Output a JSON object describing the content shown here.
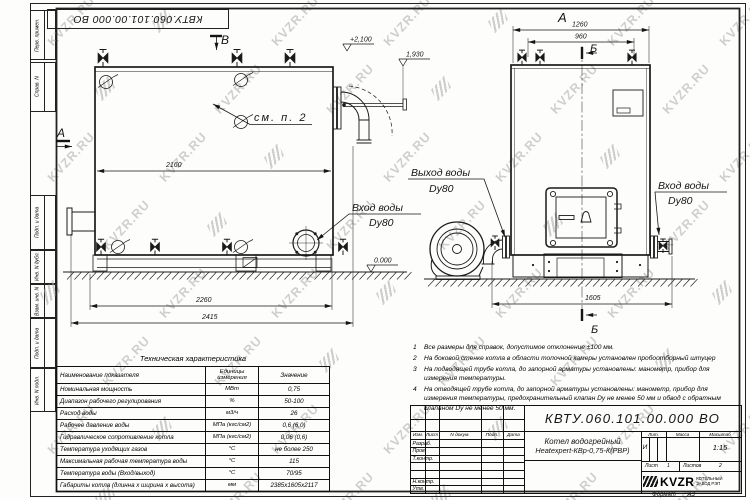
{
  "watermark": {
    "text": "KVZR.RU"
  },
  "margin_fields": [
    "Перв. примен.",
    "Справ. N",
    "Подп. и дата",
    "Инв. N дубл.",
    "Взам. инв. N",
    "Подп. и дата",
    "Инв. N подл."
  ],
  "drawing": {
    "left_view": {
      "view_arrow": "В",
      "section_label": "А",
      "note_ref": "см. п. 2",
      "elev_top": "+2,100",
      "elev_flue": "1,930",
      "elev_zero": "0.000",
      "dim_width_inner": "2160",
      "dim_width_base": "2260",
      "dim_width_total": "2415",
      "inlet_line1": "Вход воды",
      "inlet_line2": "Dy80"
    },
    "right_view": {
      "view_label": "А",
      "section_top": "Б",
      "section_bottom": "Б",
      "dim_top_outer": "1260",
      "dim_top_inner": "960",
      "dim_base": "1605",
      "outlet_line1": "Выход воды",
      "outlet_line2": "Dy80",
      "inlet_line1": "Вход воды",
      "inlet_line2": "Dy80"
    }
  },
  "spec_table": {
    "title": "Техническая характеристика",
    "headers": [
      "Наименование показателя",
      "Единицы измерения",
      "Значение"
    ],
    "rows": [
      [
        "Номинальная мощность",
        "МВт",
        "0,75"
      ],
      [
        "Диапазон рабочего регулирования",
        "%",
        "50-100"
      ],
      [
        "Расход воды",
        "м3/ч",
        "26"
      ],
      [
        "Рабочее давление воды",
        "МПа (кгс/см2)",
        "0,6 (6,0)"
      ],
      [
        "Гидравлическое сопротивление котла",
        "МПа (кгс/см2)",
        "0,06 (0,6)"
      ],
      [
        "Температура уходящих газов",
        "°С",
        "не более 250"
      ],
      [
        "Максимальная рабочая температура воды",
        "°С",
        "115"
      ],
      [
        "Температура воды (Вход/выход)",
        "°С",
        "70/95"
      ],
      [
        "Габариты котла (длинна х ширина х высота)",
        "мм",
        "2385х1605х2117"
      ]
    ]
  },
  "notes": [
    "Все размеры для справок, допустимое отклонение ±100 мм.",
    "На боковой стенке котла в области топочной камеры установлен пробоотборный штуцер",
    "На  подводящей трубе котла, до запорной арматуры установлены: манометр, прибор для измерения температуры.",
    "На отводящей трубе котла, до запорной арматуры установлены: манометр, прибор для измерения температуры, предохранительный клапан Dу не менее 50 мм и обвод с обратным клапаном Dу не менее 50 мм."
  ],
  "title_block": {
    "doc_number": "КВТУ.060.101.00.000  ВО",
    "header_cells": [
      "Изм.",
      "Лист",
      "N докум.",
      "Подп.",
      "Дата"
    ],
    "row_labels": [
      "Разраб.",
      "Пров.",
      "Т.контр.",
      "Н.контр.",
      "Утв."
    ],
    "product_line1": "Котел водогрейный",
    "product_line2": "Heatexpert-КВр-0,75-К(РВР)",
    "lit_label": "Лит.",
    "mass_label": "Масса",
    "scale_label": "Масштаб",
    "lit_value": "И",
    "scale_value": "1:15",
    "sheet_label": "Лист",
    "sheet_value": "1",
    "sheets_label": "Листов",
    "sheets_value": "2",
    "company_name": "KVZR",
    "company_line1": "КОТЕЛЬНЫЙ",
    "company_line2": "ЗАВОД РЭП",
    "format_label": "Формат",
    "format_value": "А3"
  }
}
